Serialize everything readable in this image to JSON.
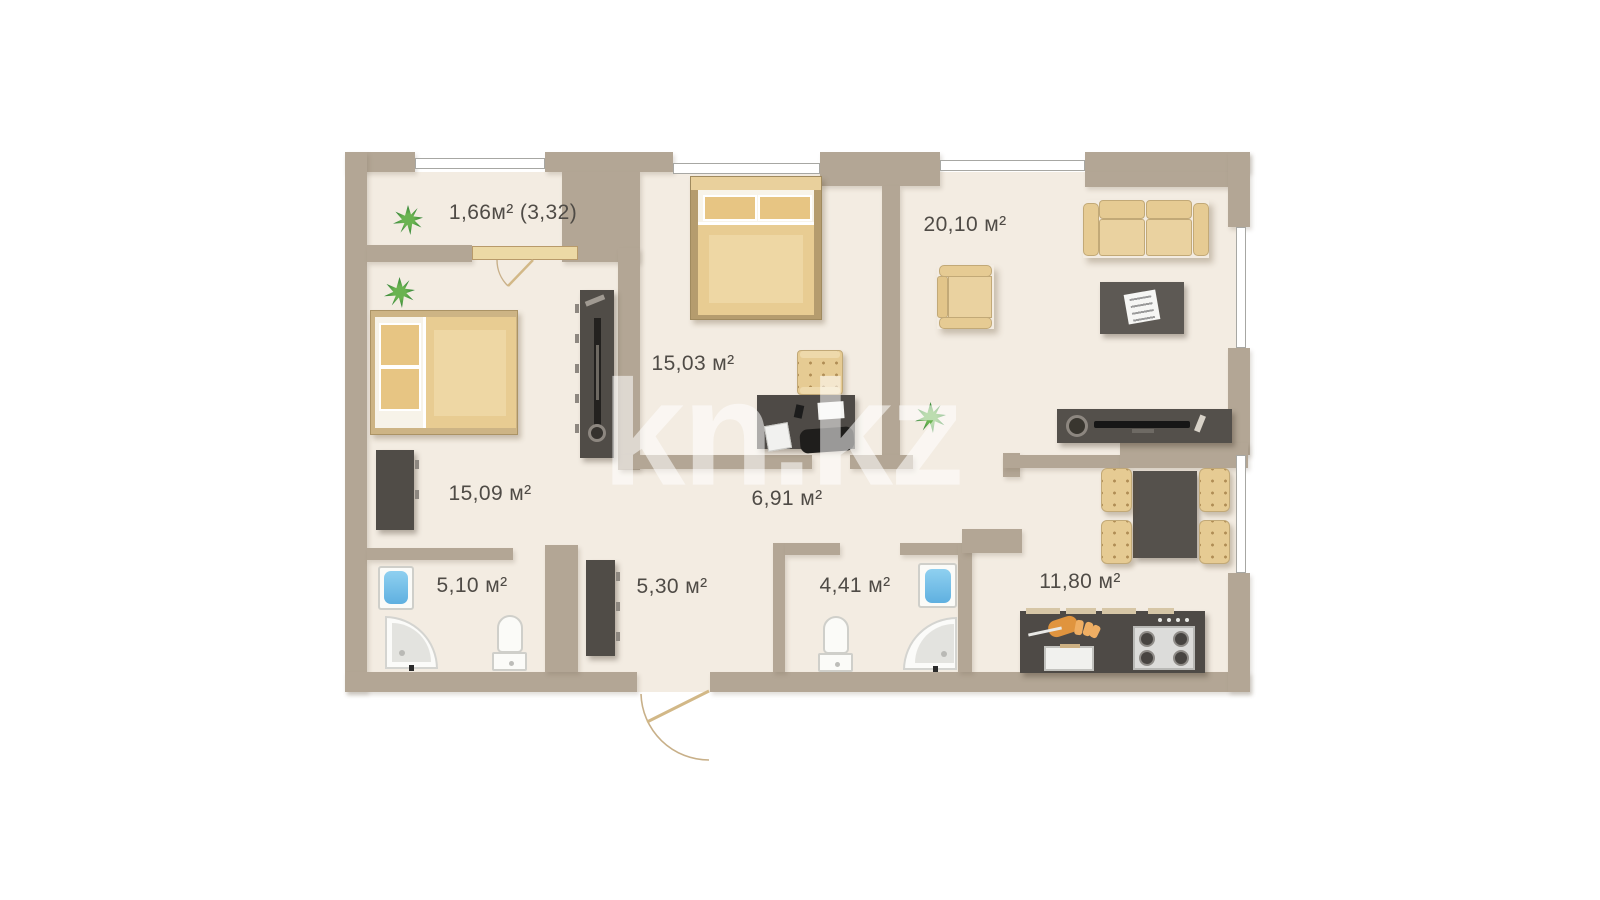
{
  "watermark": "kn.kz",
  "plan_title": "apartment-floor-plan",
  "rooms": [
    {
      "id": "balcony",
      "area_label": "1,66м² (3,32)"
    },
    {
      "id": "bedroom-left",
      "area_label": "15,09 м²"
    },
    {
      "id": "bedroom-middle",
      "area_label": "15,03 м²"
    },
    {
      "id": "living-room",
      "area_label": "20,10 м²"
    },
    {
      "id": "corridor",
      "area_label": "6,91 м²"
    },
    {
      "id": "bathroom-left",
      "area_label": "5,10 м²"
    },
    {
      "id": "hallway",
      "area_label": "5,30 м²"
    },
    {
      "id": "bathroom-right",
      "area_label": "4,41 м²"
    },
    {
      "id": "kitchen-living",
      "area_label": "11,80 м²"
    }
  ],
  "colors": {
    "wall": "#b3a695",
    "floor": "#f3ece2",
    "furniture_tan": "#e6cb93",
    "furniture_dark": "#504c47",
    "bathtub_blue": "#6cb6e3",
    "plant_green": "#3a8a3a",
    "label_text": "#4f4b46",
    "watermark": "rgba(255,255,255,0.55)"
  }
}
